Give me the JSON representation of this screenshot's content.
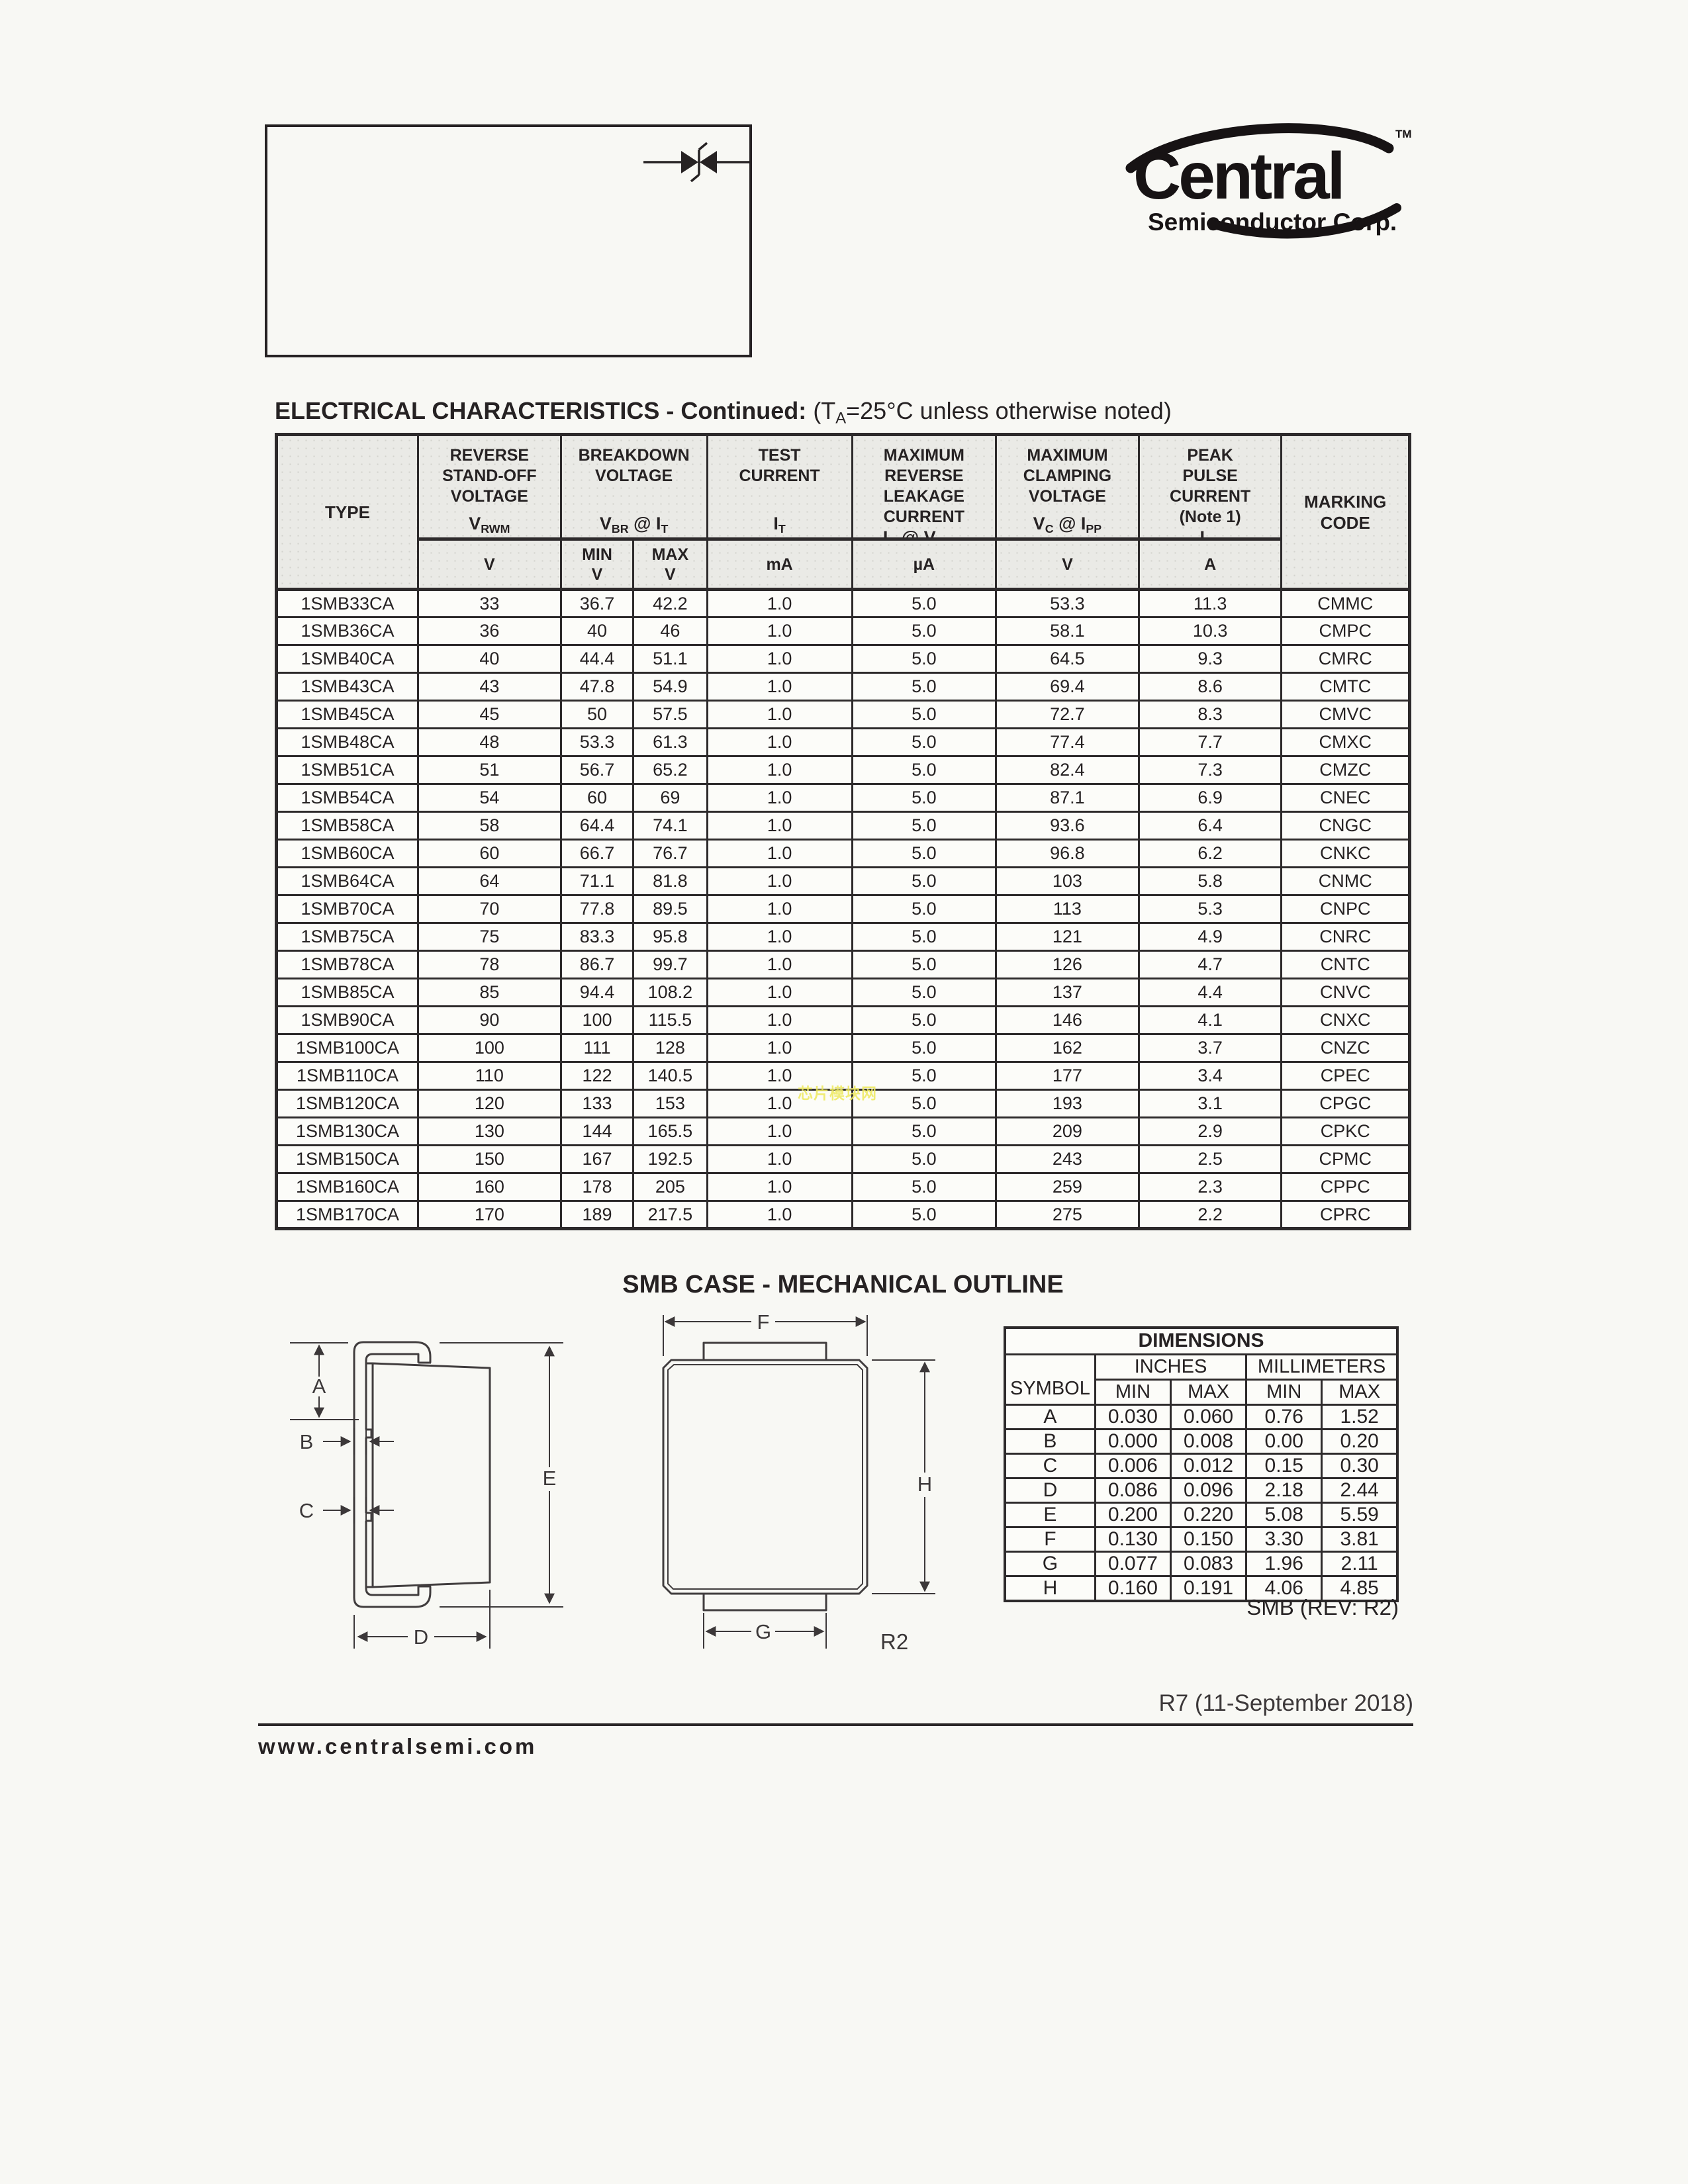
{
  "title_box": {
    "part_range_lines": [
      "1SMB5.0CA",
      "THRU",
      "1SMB170CA"
    ],
    "description_lines": [
      "SURFACE MOUNT SILICON",
      "BI-DIRECTIONAL",
      "GLASS PASSIVATED JUNCTION",
      "TRANSIENT VOLTAGE SUPPRESSORS",
      "600 WATT, 5.0 THRU 170 VOLT"
    ]
  },
  "logo": {
    "brand": "Central",
    "subtitle": "Semiconductor Corp.",
    "trademark": "TM"
  },
  "heading": {
    "bold": "ELECTRICAL CHARACTERISTICS - Continued:",
    "note": " (T~A~=25°C unless otherwise noted)"
  },
  "electrical_table": {
    "header": {
      "type_label": "TYPE",
      "marking_lines": [
        "MARKING",
        "CODE"
      ],
      "groups": [
        {
          "title_lines": [
            "REVERSE",
            "STAND-OFF",
            "VOLTAGE"
          ],
          "symbol": "V~RWM~",
          "units": [
            [
              "V"
            ]
          ]
        },
        {
          "title_lines": [
            "BREAKDOWN",
            "VOLTAGE"
          ],
          "symbol": "V~BR~ @ I~T~",
          "units": [
            [
              "MIN",
              "V"
            ],
            [
              "MAX",
              "V"
            ]
          ]
        },
        {
          "title_lines": [
            "TEST",
            "CURRENT"
          ],
          "symbol": "I~T~",
          "units": [
            [
              "mA"
            ]
          ]
        },
        {
          "title_lines": [
            "MAXIMUM",
            "REVERSE",
            "LEAKAGE",
            "CURRENT"
          ],
          "symbol": "I~R~ @ V~RWM~",
          "units": [
            [
              "µA"
            ]
          ]
        },
        {
          "title_lines": [
            "MAXIMUM",
            "CLAMPING",
            "VOLTAGE"
          ],
          "symbol": "V~C~ @ I~PP~",
          "units": [
            [
              "V"
            ]
          ]
        },
        {
          "title_lines": [
            "PEAK",
            "PULSE",
            "CURRENT",
            "(Note 1)"
          ],
          "symbol": "I~PP~",
          "units": [
            [
              "A"
            ]
          ]
        }
      ]
    },
    "rows": [
      [
        "1SMB33CA",
        "33",
        "36.7",
        "42.2",
        "1.0",
        "5.0",
        "53.3",
        "11.3",
        "CMMC"
      ],
      [
        "1SMB36CA",
        "36",
        "40",
        "46",
        "1.0",
        "5.0",
        "58.1",
        "10.3",
        "CMPC"
      ],
      [
        "1SMB40CA",
        "40",
        "44.4",
        "51.1",
        "1.0",
        "5.0",
        "64.5",
        "9.3",
        "CMRC"
      ],
      [
        "1SMB43CA",
        "43",
        "47.8",
        "54.9",
        "1.0",
        "5.0",
        "69.4",
        "8.6",
        "CMTC"
      ],
      [
        "1SMB45CA",
        "45",
        "50",
        "57.5",
        "1.0",
        "5.0",
        "72.7",
        "8.3",
        "CMVC"
      ],
      [
        "1SMB48CA",
        "48",
        "53.3",
        "61.3",
        "1.0",
        "5.0",
        "77.4",
        "7.7",
        "CMXC"
      ],
      [
        "1SMB51CA",
        "51",
        "56.7",
        "65.2",
        "1.0",
        "5.0",
        "82.4",
        "7.3",
        "CMZC"
      ],
      [
        "1SMB54CA",
        "54",
        "60",
        "69",
        "1.0",
        "5.0",
        "87.1",
        "6.9",
        "CNEC"
      ],
      [
        "1SMB58CA",
        "58",
        "64.4",
        "74.1",
        "1.0",
        "5.0",
        "93.6",
        "6.4",
        "CNGC"
      ],
      [
        "1SMB60CA",
        "60",
        "66.7",
        "76.7",
        "1.0",
        "5.0",
        "96.8",
        "6.2",
        "CNKC"
      ],
      [
        "1SMB64CA",
        "64",
        "71.1",
        "81.8",
        "1.0",
        "5.0",
        "103",
        "5.8",
        "CNMC"
      ],
      [
        "1SMB70CA",
        "70",
        "77.8",
        "89.5",
        "1.0",
        "5.0",
        "113",
        "5.3",
        "CNPC"
      ],
      [
        "1SMB75CA",
        "75",
        "83.3",
        "95.8",
        "1.0",
        "5.0",
        "121",
        "4.9",
        "CNRC"
      ],
      [
        "1SMB78CA",
        "78",
        "86.7",
        "99.7",
        "1.0",
        "5.0",
        "126",
        "4.7",
        "CNTC"
      ],
      [
        "1SMB85CA",
        "85",
        "94.4",
        "108.2",
        "1.0",
        "5.0",
        "137",
        "4.4",
        "CNVC"
      ],
      [
        "1SMB90CA",
        "90",
        "100",
        "115.5",
        "1.0",
        "5.0",
        "146",
        "4.1",
        "CNXC"
      ],
      [
        "1SMB100CA",
        "100",
        "111",
        "128",
        "1.0",
        "5.0",
        "162",
        "3.7",
        "CNZC"
      ],
      [
        "1SMB110CA",
        "110",
        "122",
        "140.5",
        "1.0",
        "5.0",
        "177",
        "3.4",
        "CPEC"
      ],
      [
        "1SMB120CA",
        "120",
        "133",
        "153",
        "1.0",
        "5.0",
        "193",
        "3.1",
        "CPGC"
      ],
      [
        "1SMB130CA",
        "130",
        "144",
        "165.5",
        "1.0",
        "5.0",
        "209",
        "2.9",
        "CPKC"
      ],
      [
        "1SMB150CA",
        "150",
        "167",
        "192.5",
        "1.0",
        "5.0",
        "243",
        "2.5",
        "CPMC"
      ],
      [
        "1SMB160CA",
        "160",
        "178",
        "205",
        "1.0",
        "5.0",
        "259",
        "2.3",
        "CPPC"
      ],
      [
        "1SMB170CA",
        "170",
        "189",
        "217.5",
        "1.0",
        "5.0",
        "275",
        "2.2",
        "CPRC"
      ]
    ]
  },
  "watermark": {
    "text": "芯片模块网"
  },
  "outline": {
    "heading": "SMB CASE - MECHANICAL OUTLINE",
    "side_labels": {
      "A": "A",
      "B": "B",
      "C": "C",
      "D": "D",
      "E": "E"
    },
    "front_labels": {
      "F": "F",
      "G": "G",
      "H": "H"
    },
    "corner_radius_note": "R2",
    "rev_note": "SMB (REV: R2)"
  },
  "dimensions_table": {
    "title": "DIMENSIONS",
    "symbol_label": "SYMBOL",
    "group_headers": [
      "INCHES",
      "MILLIMETERS"
    ],
    "col_headers": [
      "MIN",
      "MAX",
      "MIN",
      "MAX"
    ],
    "rows": [
      [
        "A",
        "0.030",
        "0.060",
        "0.76",
        "1.52"
      ],
      [
        "B",
        "0.000",
        "0.008",
        "0.00",
        "0.20"
      ],
      [
        "C",
        "0.006",
        "0.012",
        "0.15",
        "0.30"
      ],
      [
        "D",
        "0.086",
        "0.096",
        "2.18",
        "2.44"
      ],
      [
        "E",
        "0.200",
        "0.220",
        "5.08",
        "5.59"
      ],
      [
        "F",
        "0.130",
        "0.150",
        "3.30",
        "3.81"
      ],
      [
        "G",
        "0.077",
        "0.083",
        "1.96",
        "2.11"
      ],
      [
        "H",
        "0.160",
        "0.191",
        "4.06",
        "4.85"
      ]
    ]
  },
  "footer": {
    "revision_date": "R7 (11-September 2018)",
    "website": "www.centralsemi.com"
  }
}
